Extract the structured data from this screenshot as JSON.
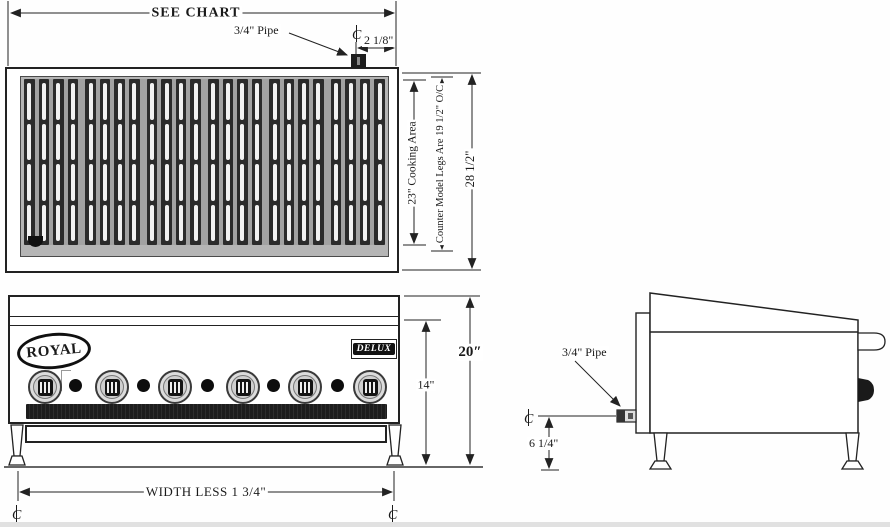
{
  "top_view": {
    "width_label": "SEE CHART",
    "pipe_label": "3/4\" Pipe",
    "pipe_offset": "2 1/8\"",
    "cooking_area": "23\" Cooking Area",
    "counter_legs": "Counter Model Legs Are 19 1/2\" O/C",
    "overall_depth": "28 1/2\"",
    "grate_sections": 6,
    "bars_per_section": 4,
    "slots_per_bar": 4
  },
  "front_view": {
    "brand_logo": "ROYAL",
    "model_badge": "DELUX",
    "burner_knobs": 6,
    "pilot_dots": 5,
    "front_panel_height": "14\"",
    "overall_height": "20″",
    "leg_spacing": "WIDTH LESS 1 3/4\""
  },
  "side_view": {
    "pipe_label": "3/4\" Pipe",
    "pipe_centerline_height": "6 1/4\""
  },
  "symbols": {
    "centerline_mark": "℄"
  },
  "colors": {
    "line": "#222222",
    "grate_dark": "#2b2b2b",
    "bed_gray": "#b5b5b5",
    "trough_dark": "#1c1c1c",
    "badge_bg": "#111111"
  }
}
